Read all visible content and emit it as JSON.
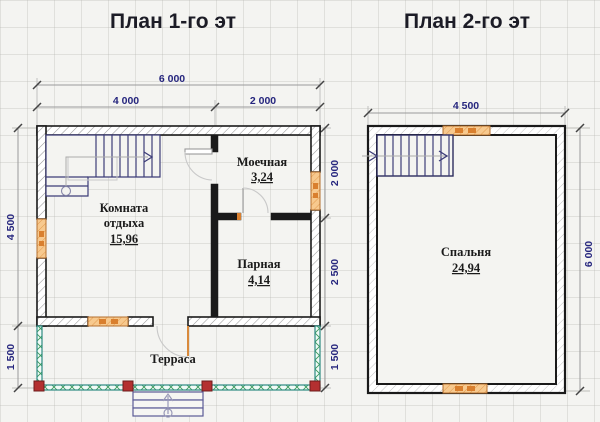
{
  "plan1": {
    "title": "План 1-го эт",
    "dim_total_width": "6 000",
    "dim_width_left": "4 000",
    "dim_width_right": "2 000",
    "dim_height_main": "4 500",
    "dim_height_terrace": "1 500",
    "dim_wash": "2 000",
    "dim_steam": "2 500",
    "dim_terrace_right": "1 500",
    "room_rest_line1": "Комната",
    "room_rest_line2": "отдыха",
    "room_rest_area": "15,96",
    "room_wash": "Моечная",
    "room_wash_area": "3,24",
    "room_steam": "Парная",
    "room_steam_area": "4,14",
    "terrace_label": "Терраса"
  },
  "plan2": {
    "title": "План 2-го эт",
    "dim_width": "4 500",
    "dim_height": "6 000",
    "room_bedroom": "Спальня",
    "room_bedroom_area": "24,94"
  },
  "colors": {
    "dimension_text": "#26267e",
    "wall": "#1a1a1a",
    "window": "#e8943c",
    "terrace_wall": "#2e8b83",
    "corner_post": "#b43030",
    "stairs": "#3c3c78",
    "background": "#f4f4f1"
  }
}
